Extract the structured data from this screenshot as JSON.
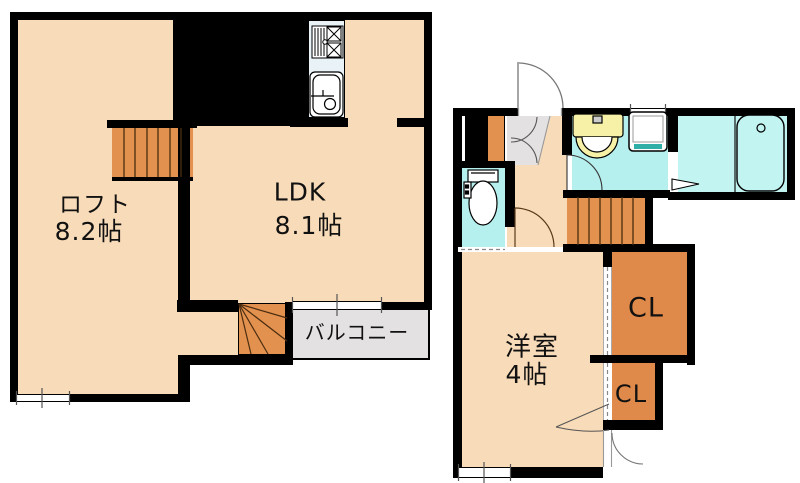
{
  "document_type": "floor-plan",
  "plans": {
    "left": {
      "loft_label": "ロフト",
      "loft_size": "8.2帖",
      "ldk_label": "LDK",
      "ldk_size": "8.1帖",
      "balcony_label": "バルコニー"
    },
    "right": {
      "room_label": "洋室",
      "room_size": "4帖",
      "closet1_label": "CL",
      "closet2_label": "CL"
    }
  },
  "colors": {
    "floor": "#F8DBB8",
    "stairs": "#E3914E",
    "closet": "#DF8A4A",
    "wet_area": "#B6F0EE",
    "bath": "#C2F4F1",
    "kitchen_unit": "#E9F2F7",
    "vanity": "#F6F1A6",
    "balcony": "#E3E1E1",
    "washer_accent": "#2FAFA8",
    "wall": "#000000"
  },
  "fixtures": [
    "kitchen-stove",
    "kitchen-sink",
    "straight-stairs",
    "winder-stairs",
    "entrance-door",
    "shoe-cabinet",
    "toilet",
    "vanity-sink",
    "washing-machine",
    "bathtub",
    "balcony-window",
    "room-window"
  ]
}
